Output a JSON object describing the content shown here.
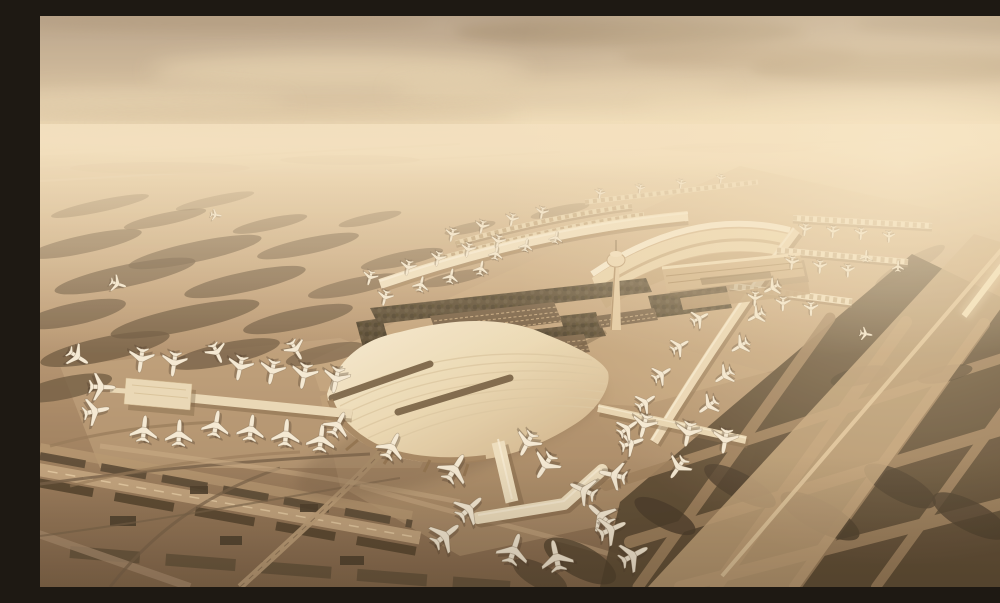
{
  "meta": {
    "title": "Aerial architectural rendering of a mega airport terminal complex at golden hour, sepia haze",
    "style": "monochrome warm sepia render, high oblique bird's-eye view",
    "visible_text": "none"
  },
  "palette": {
    "skyTop": "#b5a28c",
    "skyHorizon": "#f2e1bf",
    "sunGlow": "#fceed0",
    "groundFar": "#e9d6b2",
    "groundNear": "#7a5f45",
    "apron": "#c3a57e",
    "grassIsland": "#63503a",
    "grassDark": "#4a3a26",
    "roofLight": "#f1e5c8",
    "roofShade": "#c8ab83",
    "skylightDark": "#6f5a3f",
    "facadeShade": "#9a7b58",
    "treeFoliage": "#4a3e2a",
    "aircraftWhite": "#f6eedb",
    "shadowBrown": "#3a2d1e",
    "runwayLight": "#e6cda4",
    "corridorTan": "#bfa179",
    "towerTan": "#e2cba4"
  },
  "scene": {
    "landmarks": [
      {
        "name": "main-terminal-roof",
        "desc": "large curved ribbed roof with two dark skylight strips"
      },
      {
        "name": "north-terminal-arch",
        "desc": "crescent arched roof terminal on north side"
      },
      {
        "name": "north-spine-concourse",
        "desc": "long diagonal concourse spine with sawtooth rows"
      },
      {
        "name": "northeast-piers",
        "desc": "three parallel gate piers extending east"
      },
      {
        "name": "east-connector",
        "desc": "diagonal concourse linking north and main terminals"
      },
      {
        "name": "west-pier",
        "desc": "west concourse ending in rectangular satellite"
      },
      {
        "name": "south-pier-satellite",
        "desc": "south pier ending in chevron satellite"
      },
      {
        "name": "southeast-pier",
        "desc": "low gate pier south-east of main terminal"
      },
      {
        "name": "control-tower",
        "desc": "slender ATC tower with cab"
      },
      {
        "name": "hotel-block",
        "desc": "rectangular landside building"
      },
      {
        "name": "crescent-building",
        "desc": "curved low landside building"
      },
      {
        "name": "parking-lots",
        "desc": "car parks with rows of vehicles"
      },
      {
        "name": "tree-landscaping",
        "desc": "dense dark tree rows in central landside zone"
      },
      {
        "name": "southwest-runway",
        "desc": "diagonal runway with dark verge strips, lower left"
      },
      {
        "name": "east-runway-corridor",
        "desc": "light runway/taxiway corridor rising to hazy horizon"
      },
      {
        "name": "taxiway-islands",
        "desc": "organic dark grass islands between taxiways"
      }
    ],
    "aircraft": {
      "description": "white airliners parked nose-in at gates and taxiing",
      "position_format": "[x, y, rotationDeg, scale]",
      "count": 81,
      "positions": [
        [
          62,
          371,
          92,
          1.45
        ],
        [
          56,
          395,
          78,
          1.45
        ],
        [
          101,
          344,
          188,
          1.35
        ],
        [
          134,
          348,
          188,
          1.35
        ],
        [
          104,
          413,
          6,
          1.45
        ],
        [
          139,
          417,
          3,
          1.45
        ],
        [
          200,
          352,
          192,
          1.35
        ],
        [
          232,
          356,
          192,
          1.35
        ],
        [
          264,
          360,
          192,
          1.4
        ],
        [
          296,
          364,
          192,
          1.4
        ],
        [
          176,
          408,
          10,
          1.45
        ],
        [
          211,
          412,
          8,
          1.45
        ],
        [
          246,
          417,
          5,
          1.5
        ],
        [
          281,
          422,
          7,
          1.5
        ],
        [
          38,
          341,
          122,
          1.25
        ],
        [
          177,
          337,
          155,
          1.15
        ],
        [
          256,
          334,
          150,
          1.15
        ],
        [
          298,
          408,
          28,
          1.4
        ],
        [
          352,
          430,
          26,
          1.5
        ],
        [
          415,
          452,
          32,
          1.65
        ],
        [
          430,
          492,
          48,
          1.6
        ],
        [
          406,
          519,
          52,
          1.68
        ],
        [
          474,
          533,
          18,
          1.7
        ],
        [
          516,
          540,
          348,
          1.7
        ],
        [
          543,
          474,
          295,
          1.5
        ],
        [
          573,
          459,
          283,
          1.5
        ],
        [
          560,
          499,
          312,
          1.58
        ],
        [
          487,
          428,
          208,
          1.4
        ],
        [
          505,
          450,
          212,
          1.5
        ],
        [
          592,
          427,
          72,
          1.3
        ],
        [
          638,
          452,
          215,
          1.3
        ],
        [
          572,
          513,
          66,
          1.58
        ],
        [
          594,
          539,
          62,
          1.62
        ],
        [
          640,
          330,
          60,
          1.05
        ],
        [
          622,
          358,
          58,
          1.1
        ],
        [
          606,
          386,
          56,
          1.15
        ],
        [
          660,
          302,
          62,
          1.0
        ],
        [
          588,
          412,
          55,
          1.2
        ],
        [
          716,
          300,
          240,
          1.0
        ],
        [
          700,
          330,
          238,
          1.05
        ],
        [
          684,
          360,
          236,
          1.1
        ],
        [
          668,
          390,
          234,
          1.15
        ],
        [
          732,
          272,
          242,
          0.95
        ],
        [
          604,
          410,
          195,
          1.3
        ],
        [
          648,
          418,
          192,
          1.35
        ],
        [
          685,
          425,
          190,
          1.35
        ],
        [
          345,
          282,
          195,
          0.85
        ],
        [
          330,
          262,
          196,
          0.8
        ],
        [
          368,
          252,
          193,
          0.85
        ],
        [
          398,
          243,
          193,
          0.82
        ],
        [
          428,
          234,
          193,
          0.8
        ],
        [
          458,
          226,
          192,
          0.78
        ],
        [
          412,
          219,
          193,
          0.75
        ],
        [
          442,
          211,
          193,
          0.73
        ],
        [
          472,
          204,
          192,
          0.7
        ],
        [
          502,
          197,
          191,
          0.68
        ],
        [
          381,
          268,
          14,
          0.85
        ],
        [
          411,
          260,
          13,
          0.82
        ],
        [
          441,
          252,
          12,
          0.8
        ],
        [
          456,
          237,
          13,
          0.75
        ],
        [
          486,
          229,
          12,
          0.72
        ],
        [
          516,
          221,
          11,
          0.7
        ],
        [
          560,
          178,
          190,
          0.55
        ],
        [
          600,
          173,
          190,
          0.53
        ],
        [
          641,
          168,
          189,
          0.52
        ],
        [
          681,
          163,
          187,
          0.5
        ],
        [
          765,
          214,
          188,
          0.68
        ],
        [
          793,
          216,
          186,
          0.67
        ],
        [
          821,
          218,
          184,
          0.66
        ],
        [
          849,
          221,
          182,
          0.64
        ],
        [
          752,
          247,
          186,
          0.74
        ],
        [
          780,
          251,
          184,
          0.73
        ],
        [
          808,
          255,
          182,
          0.71
        ],
        [
          715,
          283,
          184,
          0.8
        ],
        [
          743,
          288,
          182,
          0.79
        ],
        [
          771,
          293,
          180,
          0.77
        ],
        [
          858,
          250,
          2,
          0.62
        ],
        [
          826,
          240,
          5,
          0.66
        ],
        [
          78,
          268,
          108,
          0.9
        ],
        [
          176,
          199,
          98,
          0.62
        ],
        [
          826,
          318,
          100,
          0.7
        ]
      ]
    }
  }
}
